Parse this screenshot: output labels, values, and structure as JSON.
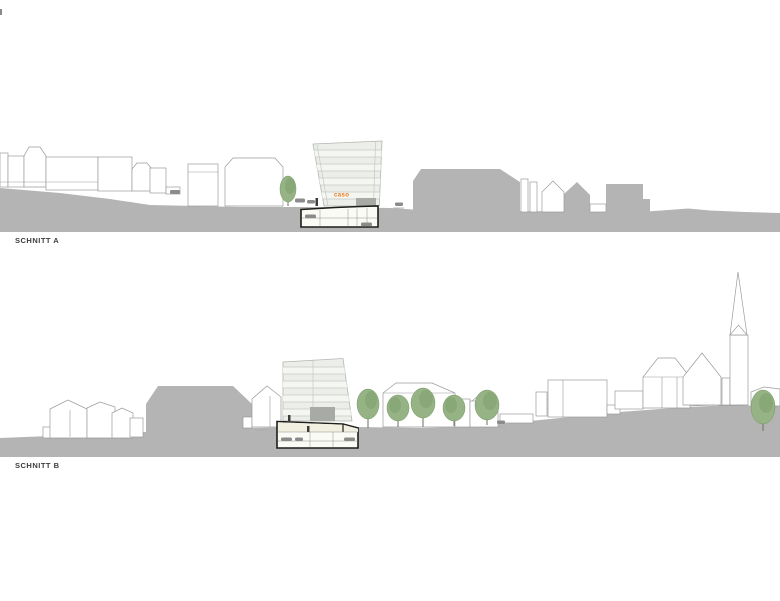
{
  "sections": {
    "a": {
      "label": "SCHNITT A"
    },
    "b": {
      "label": "SCHNITT B"
    }
  },
  "logo": {
    "text": "caso"
  },
  "colors": {
    "ground": "#b4b4b4",
    "outline": "#9a9a9a",
    "glass": "#ebeee9",
    "glassline": "#c6c9c3",
    "cream": "#f1efdf",
    "accent": "#e8791e",
    "tree": "#96b386",
    "treedark": "#74965f",
    "ink": "#1d1d1b",
    "label": "#3c3c3b",
    "car": "#8b8b8b",
    "block": "#a8aaa5"
  }
}
